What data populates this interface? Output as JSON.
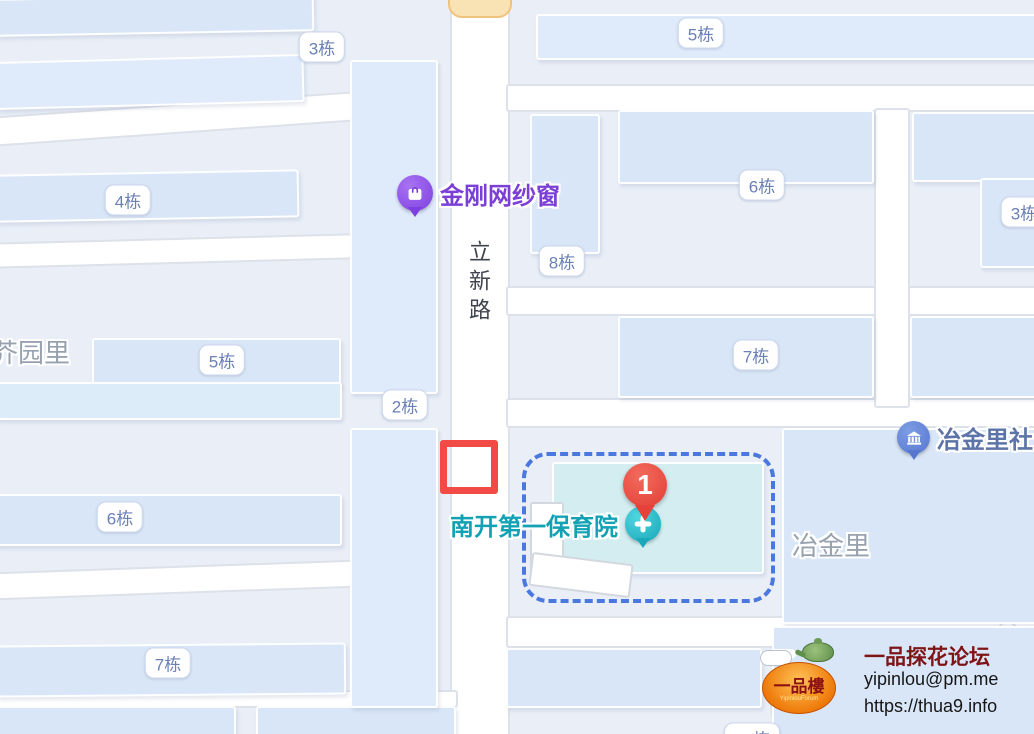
{
  "map": {
    "road_label": {
      "text": "立新路"
    },
    "building_labels": [
      {
        "text": "3栋",
        "x": 322,
        "y": 47
      },
      {
        "text": "5栋",
        "x": 701,
        "y": 33
      },
      {
        "text": "4栋",
        "x": 128,
        "y": 200
      },
      {
        "text": "6栋",
        "x": 762,
        "y": 185
      },
      {
        "text": "3栋",
        "x": 1024,
        "y": 212
      },
      {
        "text": "8栋",
        "x": 562,
        "y": 261
      },
      {
        "text": "7栋",
        "x": 756,
        "y": 355
      },
      {
        "text": "5栋",
        "x": 222,
        "y": 360
      },
      {
        "text": "2栋",
        "x": 405,
        "y": 405
      },
      {
        "text": "6栋",
        "x": 120,
        "y": 517
      },
      {
        "text": "7栋",
        "x": 168,
        "y": 663
      },
      {
        "text": "13栋",
        "x": 752,
        "y": 738
      }
    ],
    "area_labels": [
      {
        "text": "芥园里",
        "x": -8,
        "y": 333
      },
      {
        "text": "冶金里",
        "x": 792,
        "y": 526
      }
    ],
    "pois": {
      "shop": {
        "label": "金刚网纱窗"
      },
      "kindergarten": {
        "label": "南开第一保育院"
      },
      "community": {
        "label": "冶金里社"
      }
    },
    "marker": {
      "label": "1"
    }
  },
  "watermark": {
    "title": "一品探花论坛",
    "email": "yipinlou@pm.me",
    "url": "https://thua9.info",
    "logo_main": "一品樓",
    "logo_sub": "YipinlouForum"
  },
  "colors": {
    "poi_shop": "#7b3fd6",
    "poi_kindergarten": "#12a2b4",
    "poi_community": "#5d74a8",
    "marker_red": "#e6413a",
    "annotation_red": "#f24b45",
    "selection_blue": "#4a78df"
  }
}
